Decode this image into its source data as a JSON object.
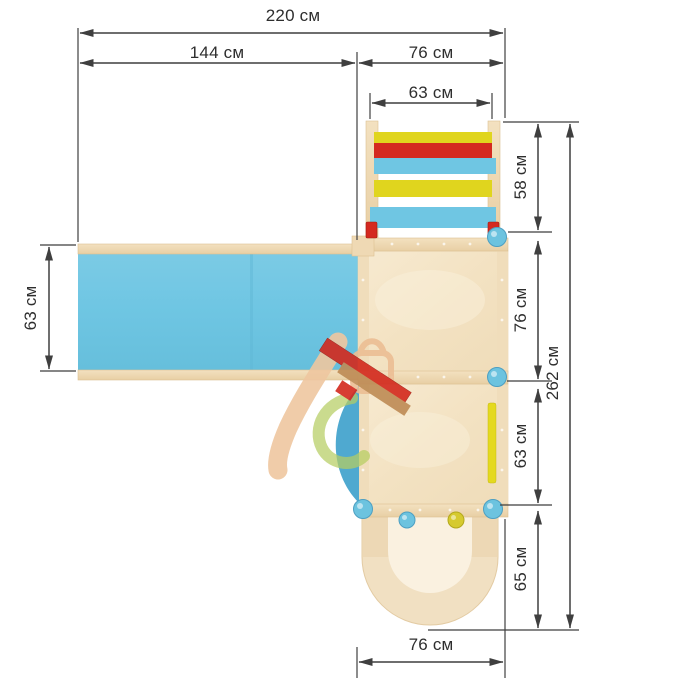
{
  "drawing": {
    "type": "top-view dimensional drawing of playground structure",
    "units": "см",
    "dims": {
      "top_total": "220 см",
      "top_slide": "144 см",
      "top_tower": "76 см",
      "top_ladder": "63 см",
      "left_slide_width": "63 см",
      "right_ladder_depth": "58 см",
      "right_upper_platform": "76 см",
      "right_lower_platform": "63 см",
      "right_front_section": "65 см",
      "right_total_depth": "262 см",
      "bottom_tower_width": "76 см"
    },
    "colors": {
      "slide_blue": "#6FC6E3",
      "rung_yellow": "#E0D51E",
      "rung_red": "#D42920",
      "wood_beam": "#EFD9B4",
      "plywood_floor": "#F5E6C9",
      "ball_blue": "#6CC3DF",
      "ball_yellow": "#D6CA2F",
      "side_lens_blue": "#4FA9D0",
      "dimension_line": "#3F3F3F"
    }
  }
}
